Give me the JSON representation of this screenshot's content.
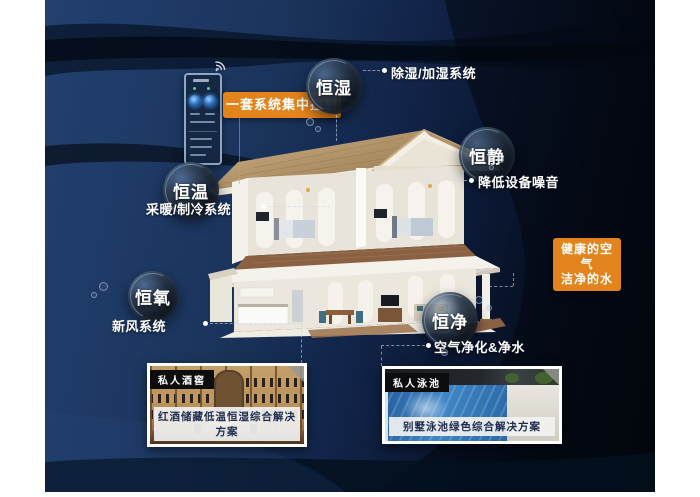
{
  "colors": {
    "accent_orange": "#e2831c",
    "background_navy": "#1e3a69",
    "background_dark": "#04070e",
    "label_text": "#ffffff",
    "caption_text": "#1d2b4d"
  },
  "control_panel": {
    "label": "一套系统集中控制"
  },
  "bubbles": {
    "humidity": {
      "label": "恒湿",
      "sub": "除湿/加湿系统"
    },
    "quiet": {
      "label": "恒静",
      "sub": "降低设备噪音"
    },
    "temperature": {
      "label": "恒温",
      "sub": "采暖/制冷系统"
    },
    "oxygen": {
      "label": "恒氧",
      "sub": "新风系统"
    },
    "purity": {
      "label": "恒净",
      "sub": "空气净化&净水"
    }
  },
  "callout": {
    "line1": "健康的空气",
    "line2": "洁净的水"
  },
  "photos": {
    "wine_cellar": {
      "tag": "私人酒窖",
      "caption": "红酒储藏低温恒湿综合解决方案"
    },
    "pool": {
      "tag": "私人泳池",
      "caption": "别墅泳池绿色综合解决方案"
    }
  }
}
